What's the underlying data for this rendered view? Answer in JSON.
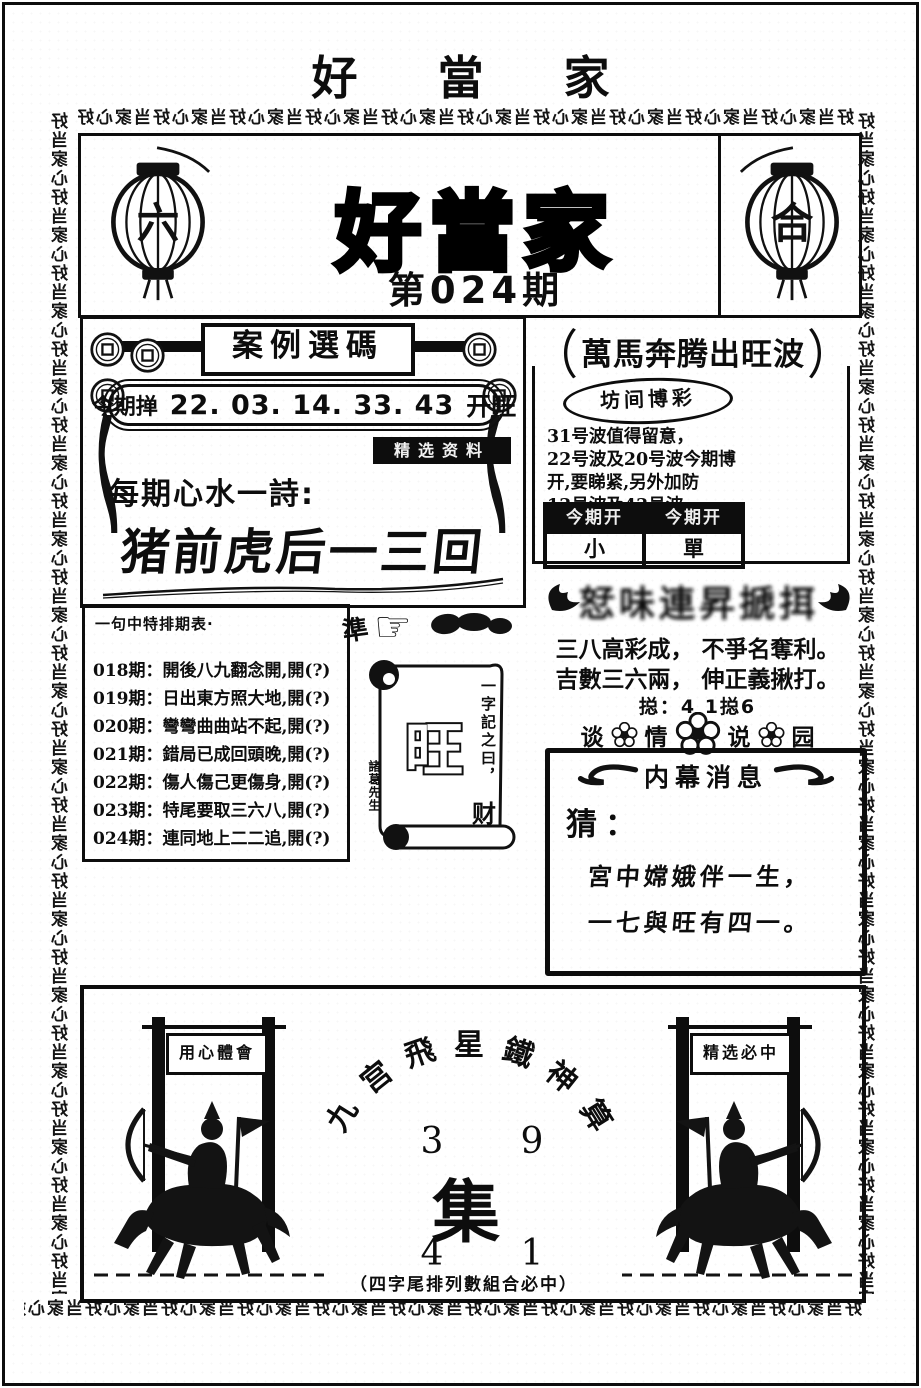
{
  "page": {
    "top_title": "好 當 家",
    "strip_unit": "好当家心",
    "ink_color": "#0d0d0d",
    "paper_color": "#ffffff"
  },
  "header": {
    "lantern_left_char": "六",
    "lantern_right_char": "合",
    "main_title": "好當家",
    "issue_label": "第024期"
  },
  "case_panel": {
    "title": "案例選碼",
    "draw_label": "今期掸",
    "draw_numbers": "22. 03. 14. 33. 43",
    "draw_result": "开旺",
    "inverted_tag": "精选资料",
    "poem_label": "每期心水一詩:",
    "poem_text": "猪前虎后一三回"
  },
  "wave_panel": {
    "paren_left": "（",
    "paren_right": "）",
    "title": "萬馬奔腾出旺波",
    "oval_label": "坊间博彩",
    "body_lines": [
      "31号波值得留意，",
      "22号波及20号波今期博",
      "开,要睇紧,另外加防",
      "13号波及43号波."
    ],
    "col1_header": "今期开",
    "col2_header": "今期开",
    "col1_value": "小",
    "col2_value": "單"
  },
  "history_panel": {
    "title": "一句中特排期表·",
    "rows": [
      "018期：開後八九翻念開,開(?)",
      "019期：日出東方照大地,開(?)",
      "020期：彎彎曲曲站不起,開(?)",
      "021期：錯局已成回頭晚,開(?)",
      "022期：傷人傷己更傷身,開(?)",
      "023期：特尾要取三六八,開(?)",
      "024期：連同地上二二追,開(?)"
    ]
  },
  "scroll_area": {
    "accuracy_char": "準",
    "pointer_icon": "☞",
    "scroll_word": "旺",
    "scroll_caption": "一字記之曰，",
    "scroll_answer": "财",
    "scroll_signature": "諸葛先生"
  },
  "tips_panel": {
    "smudged_text": "恏味連昇搋挕",
    "poem_line1": "三八高彩成， 不爭名奪利。",
    "poem_line2": "吉數三六兩， 伸正義揪打。",
    "total_line": "搃：4 1搃6",
    "flower_chars": [
      "谈",
      "情",
      "说",
      "园"
    ]
  },
  "insider_panel": {
    "title": "内幕消息",
    "guess_label": "猜：",
    "line1": "宮中嫦娥伴一生，",
    "line2": "一七與旺有四一。"
  },
  "bottom_panel": {
    "arc_title_chars": [
      "九",
      "宫",
      "飛",
      "星",
      "鐵",
      "神",
      "算"
    ],
    "num_top_left": "3",
    "num_top_right": "9",
    "center_char": "集",
    "num_bottom_left": "4",
    "num_bottom_right": "1",
    "caption": "（四字尾排列數組合必中）",
    "left_gate_banner": "用心體會",
    "right_gate_banner": "精选必中"
  }
}
